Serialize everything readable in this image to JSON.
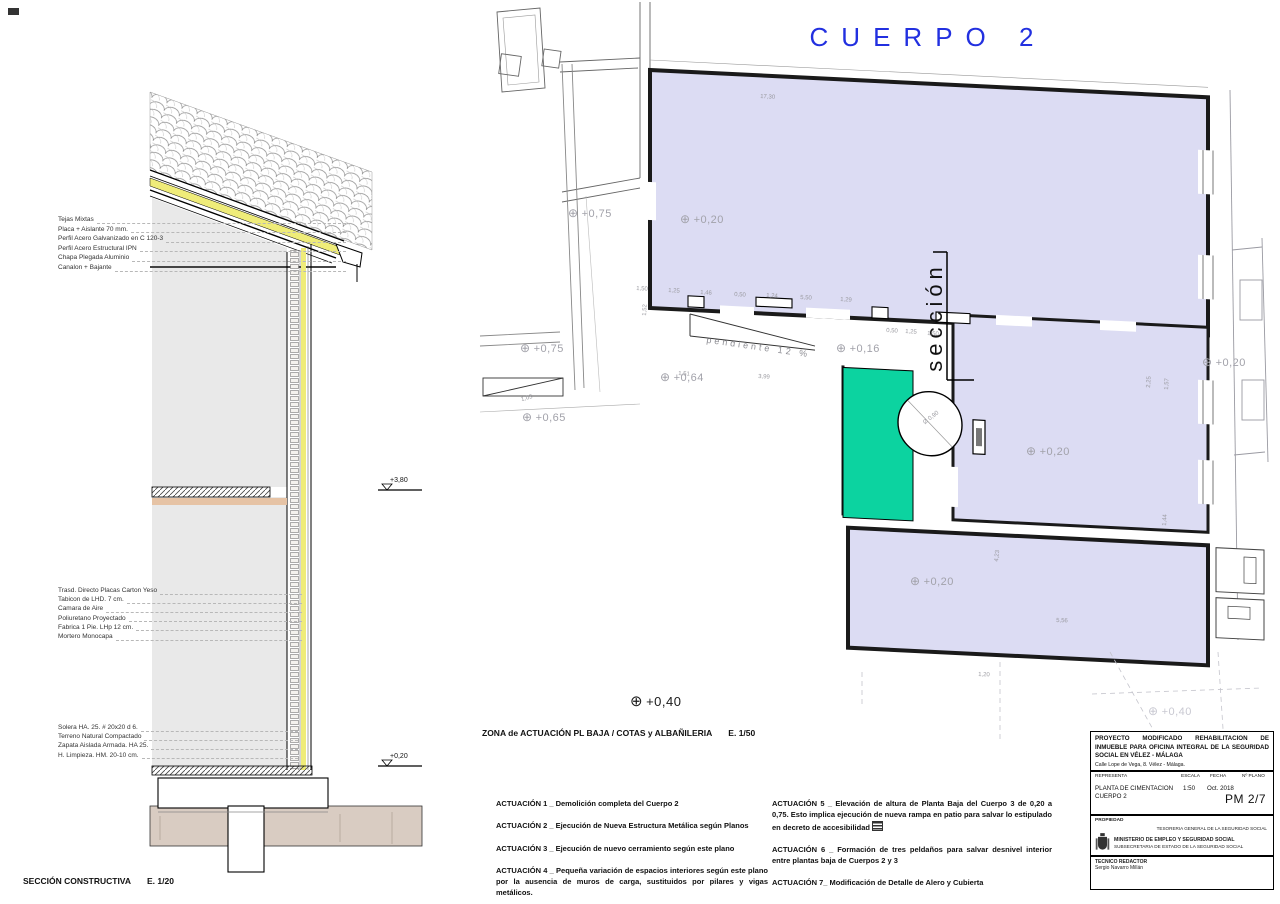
{
  "plan": {
    "title": "CUERPO 2",
    "zone_caption": "ZONA de ACTUACIÓN  PL BAJA / COTAS y ALBAÑILERIA",
    "zone_scale": "E. 1/50",
    "section_word": "sección",
    "ramp_text": "pendiente 12 %",
    "spot_symbol": "⊕",
    "spot_big": "+0,40",
    "spots": [
      {
        "t": "+0,75",
        "x": 568,
        "y": 206
      },
      {
        "t": "+0,20",
        "x": 680,
        "y": 212
      },
      {
        "t": "+0,75",
        "x": 520,
        "y": 341
      },
      {
        "t": "+0,16",
        "x": 836,
        "y": 341
      },
      {
        "t": "+0,64",
        "x": 660,
        "y": 370
      },
      {
        "t": "+0,65",
        "x": 522,
        "y": 410
      },
      {
        "t": "+0,20",
        "x": 1026,
        "y": 444
      },
      {
        "t": "+0,20",
        "x": 1202,
        "y": 355
      },
      {
        "t": "+0,20",
        "x": 910,
        "y": 574
      },
      {
        "t": "+0,40",
        "x": 1148,
        "y": 704,
        "cls": "faint"
      }
    ],
    "dims": [
      {
        "t": "17,30",
        "x": 760,
        "y": 94,
        "r": 3
      },
      {
        "t": "1,50",
        "x": 636,
        "y": 286,
        "r": 3
      },
      {
        "t": "1,25",
        "x": 668,
        "y": 288,
        "r": 3
      },
      {
        "t": "1,46",
        "x": 700,
        "y": 290,
        "r": 3
      },
      {
        "t": "0,50",
        "x": 734,
        "y": 292,
        "r": 3
      },
      {
        "t": "1,24",
        "x": 766,
        "y": 293,
        "r": 3
      },
      {
        "t": "5,50",
        "x": 800,
        "y": 295,
        "r": 3
      },
      {
        "t": "1,29",
        "x": 840,
        "y": 297,
        "r": 3
      },
      {
        "t": "0,50",
        "x": 886,
        "y": 328,
        "r": 3
      },
      {
        "t": "1,25",
        "x": 905,
        "y": 329,
        "r": 3
      },
      {
        "t": "1,50",
        "x": 927,
        "y": 331,
        "r": 3
      },
      {
        "t": "1,51",
        "x": 678,
        "y": 371,
        "r": 3
      },
      {
        "t": "3,99",
        "x": 758,
        "y": 374,
        "r": 3
      },
      {
        "t": "1,52",
        "x": 648,
        "y": 310,
        "r": -87
      },
      {
        "t": "1,03",
        "x": 522,
        "y": 397,
        "r": -15
      },
      {
        "t": "2,25",
        "x": 1152,
        "y": 382,
        "r": -87
      },
      {
        "t": "1,57",
        "x": 1170,
        "y": 384,
        "r": -87
      },
      {
        "t": "1,44",
        "x": 1168,
        "y": 520,
        "r": -87
      },
      {
        "t": "4,23",
        "x": 1000,
        "y": 556,
        "r": -84
      },
      {
        "t": "5,56",
        "x": 1056,
        "y": 618,
        "r": 2
      },
      {
        "t": "1,20",
        "x": 978,
        "y": 672,
        "r": 2
      },
      {
        "t": "Ø 0,90",
        "x": 926,
        "y": 420,
        "r": -38
      }
    ]
  },
  "section": {
    "caption": "SECCIÓN CONSTRUCTIVA",
    "caption_scale": "E. 1/20",
    "level_upper": "+3,80",
    "level_lower": "+0,20",
    "roof_labels": [
      "Tejas Mixtas",
      "Placa + Aislante 70 mm.",
      "Perfil Acero Galvanizado en C 120-3",
      "Perfil Acero Estructural IPN",
      "Chapa Plegada Aluminio",
      "Canalon + Bajante"
    ],
    "wall_labels": [
      "Trasd. Directo Placas Carton Yeso",
      "Tabicon de LHD. 7 cm.",
      "Camara de Aire",
      "Poliuretano Proyectado",
      "Fabrica 1 Pie. LHp 12 cm.",
      "Mortero Monocapa"
    ],
    "foundation_labels": [
      "Solera HA. 25. # 20x20 d 6.",
      "Terreno Natural Compactado",
      "Zapata Aislada Armada. HA 25.",
      "H. Limpieza. HM. 20-10 cm."
    ]
  },
  "notes": {
    "left": [
      "ACTUACIÓN 1 _ Demolición completa del Cuerpo 2",
      "ACTUACIÓN 2 _ Ejecución de Nueva Estructura Metálica según Planos",
      "ACTUACIÓN 3 _ Ejecución de nuevo cerramiento según este plano",
      "ACTUACIÓN 4 _ Pequeña variación de espacios interiores según este plano por la ausencia de muros de carga, sustituidos por pilares y vigas metálicos."
    ],
    "right": [
      "ACTUACIÓN 5 _ Elevación de altura de Planta Baja del Cuerpo 3 de 0,20 a 0,75. Esto implica ejecución de nueva rampa en patio para salvar lo estipulado en decreto de accesibilidad",
      "ACTUACIÓN 6 _ Formación de tres peldaños para salvar desnivel interior entre plantas baja de Cuerpos 2 y 3",
      "ACTUACIÓN 7_ Modificación de Detalle de Alero y Cubierta"
    ]
  },
  "titleblock": {
    "project": "PROYECTO MODIFICADO REHABILITACION DE INMUEBLE PARA OFICINA INTEGRAL DE LA SEGURIDAD SOCIAL EN VÉLEZ - MÁLAGA",
    "address": "Calle Lope de Vega, 8. Vélez - Málaga.",
    "col_representa": "REPRESENTA",
    "col_escala": "ESCALA",
    "col_fecha": "FECHA",
    "col_nplano": "Nº PLANO",
    "representa_line1": "PLANTA DE CIMENTACION",
    "representa_line2": "CUERPO 2",
    "escala": "1:50",
    "fecha": "Oct. 2018",
    "nplano": "PM 2/7",
    "propiedad_label": "PROPIEDAD",
    "tesoreria": "TESORERIA GENERAL DE LA SEGURIDAD SOCIAL",
    "ministerio": "MINISTERIO DE EMPLEO Y SEGURIDAD SOCIAL",
    "subsecretaria": "SUBSECRETARIA DE ESTADO DE LA SEGURIDAD SOCIAL",
    "tecnico_label": "TECNICO REDACTOR",
    "tecnico": "Sergio Navarro Millán"
  },
  "colors": {
    "accent_blue": "#2230e0",
    "lavender": "#dcdcf3",
    "green": "#0cd3a0",
    "yellow": "#efec79",
    "beige": "#d9ccc2",
    "slab_tan": "#e6c3a5"
  }
}
